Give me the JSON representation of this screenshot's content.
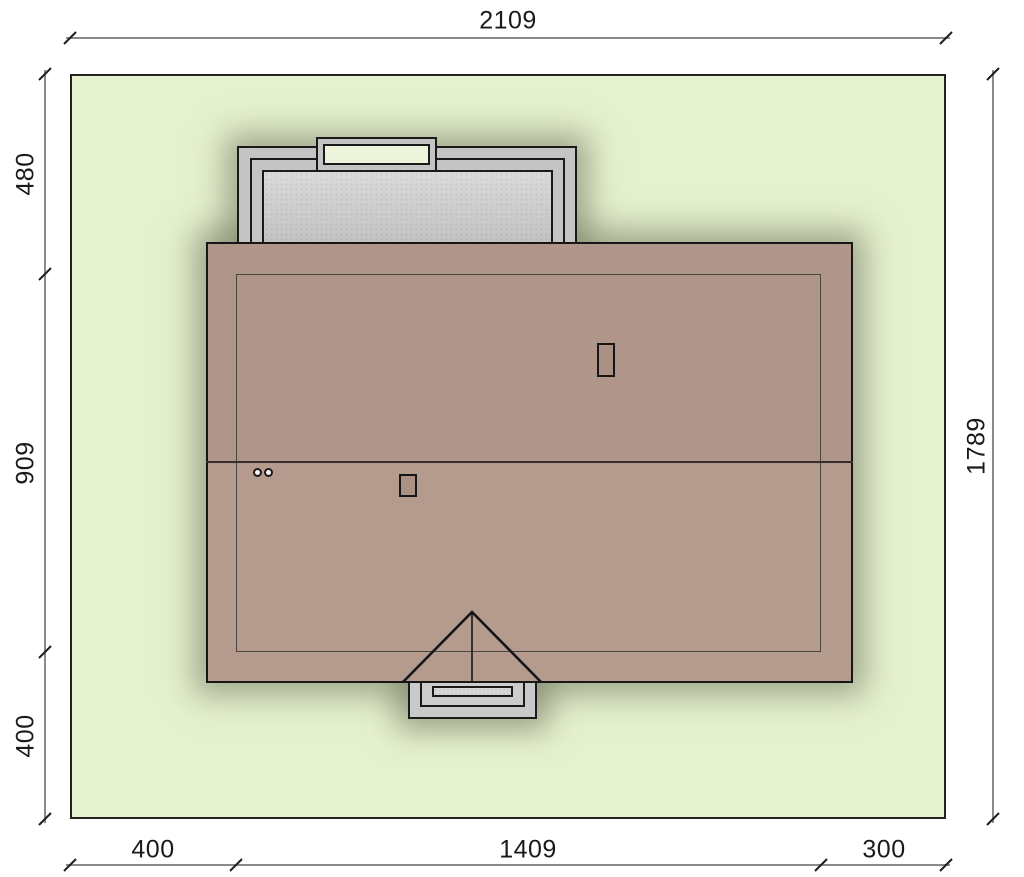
{
  "site_plan": {
    "dimensions": {
      "top": "2109",
      "right": "1789",
      "left": [
        "480",
        "909",
        "400"
      ],
      "bottom": [
        "400",
        "1409",
        "300"
      ]
    },
    "colors": {
      "plot_green": "#e6f2ce",
      "roof_brown": "#b29889",
      "paving_gray": "#c9c9c9",
      "landing_green": "#ecf4db",
      "line_black": "#1a1a1a",
      "dimension_line_gray": "#8a8a8a"
    },
    "elements": {
      "plot": "fenced plot boundary",
      "house": "hip-free gable roof plan with ridge",
      "chimney_count": 2,
      "vent_pipe_count": 2,
      "rear_structure": "terrace with landing step",
      "front_structure": "gabled entry porch with steps"
    }
  }
}
